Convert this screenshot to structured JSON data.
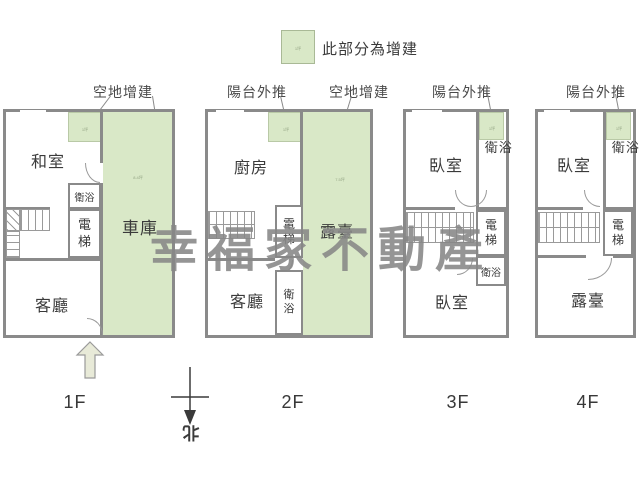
{
  "legend": {
    "label": "此部分為增建",
    "swatch_note": "1坪"
  },
  "annotations": {
    "f1_vacant": "空地增建",
    "f2_balcony": "陽台外推",
    "f2_vacant": "空地增建",
    "f3_balcony": "陽台外推",
    "f4_balcony": "陽台外推"
  },
  "watermark": "幸福家不動產",
  "compass": {
    "north": "北"
  },
  "floors": {
    "f1": {
      "label": "1F",
      "tatami": "和室",
      "bath": "衛浴",
      "elevator": "電梯",
      "living": "客廳",
      "garage": "車庫",
      "garage_note": "8.4坪",
      "patch_note": "1坪"
    },
    "f2": {
      "label": "2F",
      "kitchen": "廚房",
      "elevator": "電梯",
      "terrace": "露臺",
      "bath": "衛浴",
      "living": "客廳",
      "terrace_note": "7.5坪",
      "patch_note": "1坪"
    },
    "f3": {
      "label": "3F",
      "bedroom_top": "臥室",
      "bath_top": "衛浴",
      "elevator": "電梯",
      "bath_small": "衛浴",
      "bedroom_bottom": "臥室",
      "patch_note": "1坪"
    },
    "f4": {
      "label": "4F",
      "bedroom": "臥室",
      "bath": "衛浴",
      "elevator": "電梯",
      "terrace": "露臺",
      "patch_note": "1坪"
    }
  },
  "colors": {
    "addition_green": "#d9e8c7",
    "wall_gray": "#8a8a8a"
  }
}
